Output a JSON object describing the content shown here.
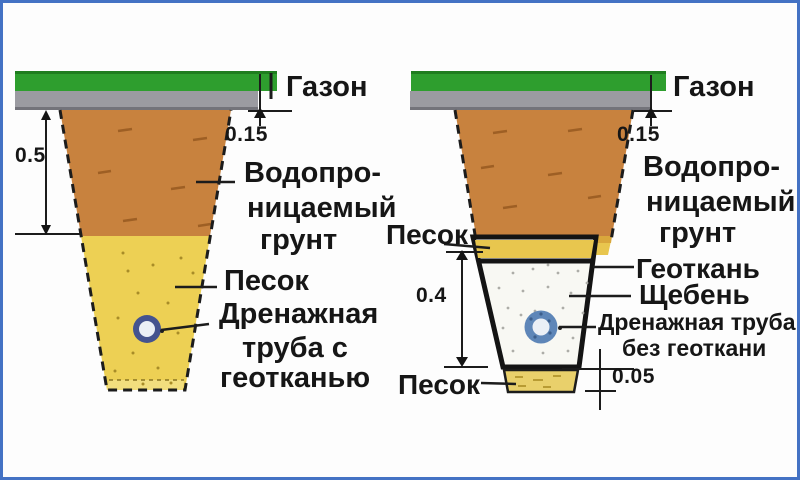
{
  "diagram": {
    "left": {
      "gazon": "Газон",
      "dim_top_layer": "0.15",
      "dim_depth": "0.5",
      "soil_line1": "Водопро-",
      "soil_line2": "ницаемый",
      "soil_line3": "грунт",
      "sand": "Песок",
      "pipe_line1": "Дренажная",
      "pipe_line2": "труба с",
      "pipe_line3": "геотканью"
    },
    "right": {
      "gazon": "Газон",
      "dim_top_layer": "0.15",
      "dim_gravel_depth": "0.4",
      "dim_sand_bed": "0.05",
      "soil_line1": "Водопро-",
      "soil_line2": "ницаемый",
      "soil_line3": "грунт",
      "sand_top": "Песок",
      "geotextile": "Геоткань",
      "gravel": "Щебень",
      "pipe_line1": "Дренажная труба",
      "pipe_line2": "без геоткани",
      "sand_bottom": "Песок"
    },
    "colors": {
      "frame_border": "#4472C4",
      "lawn_green": "#2E9E2E",
      "lawn_green_dark": "#1F7D1F",
      "base_gray": "#9B9BA1",
      "base_gray_dark": "#73737A",
      "soil_brown": "#C8823E",
      "sand_yellow": "#EDD054",
      "sand_band_top": "#D9A73C",
      "sand_band": "#E8C64E",
      "sand_bed": "#E9D06B",
      "gravel_white": "#F8F8F3",
      "pipe_ring_navy": "#44538F",
      "pipe_ring_blue": "#5E86B8",
      "pipe_center": "#EAEFF6",
      "outline_black": "#141414"
    }
  }
}
